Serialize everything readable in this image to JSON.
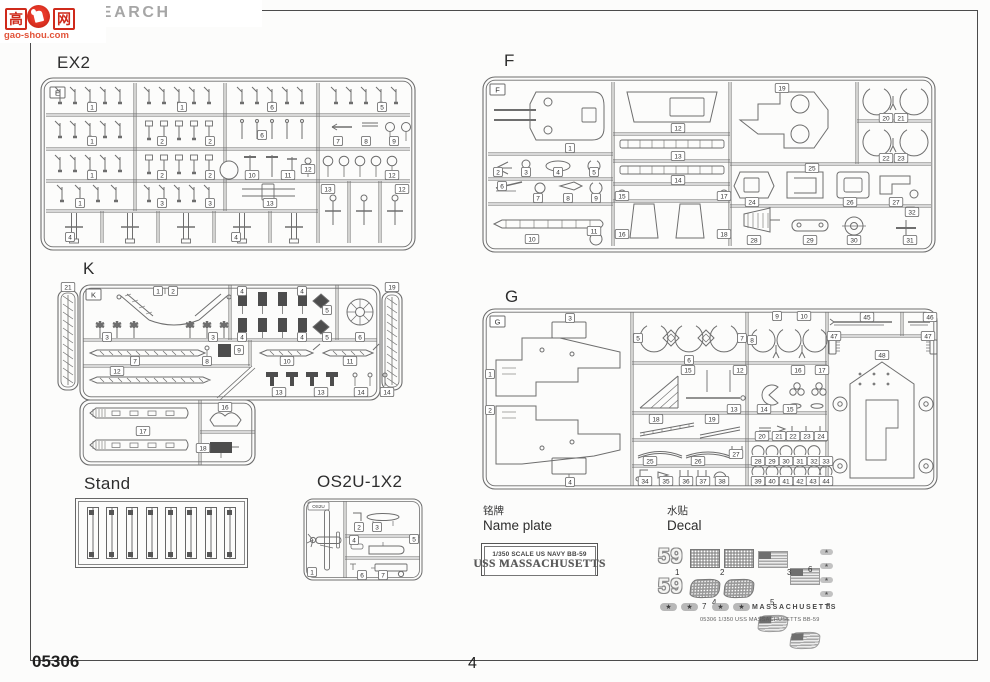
{
  "page": {
    "footer_code": "05306",
    "page_number": "4"
  },
  "watermark": {
    "brand": "HOBBY SEARCH",
    "logo_cn_left": "高",
    "logo_cn_right": "网",
    "logo_site": "gao-shou.com",
    "brand_color": "#a6a6a6",
    "logo_color": "#cf2a1b"
  },
  "sections": {
    "ex2": {
      "title": "EX2",
      "letter": "E"
    },
    "f": {
      "title": "F",
      "letter": "F"
    },
    "k": {
      "title": "K",
      "letter": "K"
    },
    "g": {
      "title": "G",
      "letter": "G"
    },
    "stand": {
      "title": "Stand"
    },
    "os2u": {
      "title": "OS2U-1X2",
      "letter": "OS2U"
    }
  },
  "nameplate": {
    "label_cn": "铭牌",
    "label_en": "Name plate",
    "line1": "1/350  SCALE  US  NAVY  BB-59",
    "line2": "USS MASSACHUSETTS"
  },
  "decal": {
    "label_cn": "水贴",
    "label_en": "Decal",
    "hull_number": "59",
    "ship_name_text": "MASSACHUSETTS",
    "footnote": "05306   1/350 USS MASSACHUSETTS BB-59",
    "item_numbers": [
      "1",
      "2",
      "3",
      "4",
      "5",
      "6",
      "7",
      "8"
    ]
  },
  "part_tags": {
    "e": [
      [
        "1",
        52,
        30
      ],
      [
        "1",
        142,
        30
      ],
      [
        "6",
        232,
        30
      ],
      [
        "5",
        342,
        30
      ],
      [
        "1",
        52,
        64
      ],
      [
        "2",
        122,
        64
      ],
      [
        "2",
        170,
        64
      ],
      [
        "6",
        222,
        58
      ],
      [
        "7",
        298,
        64
      ],
      [
        "8",
        326,
        64
      ],
      [
        "9",
        354,
        64
      ],
      [
        "1",
        52,
        98
      ],
      [
        "2",
        122,
        98
      ],
      [
        "2",
        170,
        98
      ],
      [
        "10",
        212,
        98
      ],
      [
        "11",
        248,
        98
      ],
      [
        "12",
        268,
        92
      ],
      [
        "12",
        352,
        98
      ],
      [
        "1",
        40,
        126
      ],
      [
        "3",
        122,
        126
      ],
      [
        "3",
        170,
        126
      ],
      [
        "13",
        230,
        126
      ],
      [
        "4",
        30,
        160
      ],
      [
        "4",
        196,
        160
      ],
      [
        "13",
        288,
        112
      ],
      [
        "12",
        362,
        112
      ]
    ],
    "f": [
      [
        "1",
        88,
        72
      ],
      [
        "2",
        16,
        96
      ],
      [
        "3",
        44,
        96
      ],
      [
        "4",
        76,
        96
      ],
      [
        "5",
        112,
        96
      ],
      [
        "6",
        20,
        110
      ],
      [
        "7",
        56,
        122
      ],
      [
        "8",
        86,
        122
      ],
      [
        "9",
        114,
        122
      ],
      [
        "10",
        50,
        163
      ],
      [
        "11",
        112,
        155
      ],
      [
        "12",
        196,
        52
      ],
      [
        "13",
        196,
        80
      ],
      [
        "14",
        196,
        104
      ],
      [
        "15",
        140,
        120
      ],
      [
        "17",
        242,
        120
      ],
      [
        "16",
        140,
        158
      ],
      [
        "18",
        242,
        158
      ],
      [
        "19",
        300,
        12
      ],
      [
        "20",
        404,
        42
      ],
      [
        "21",
        419,
        42
      ],
      [
        "22",
        404,
        82
      ],
      [
        "23",
        419,
        82
      ],
      [
        "25",
        330,
        92
      ],
      [
        "24",
        270,
        126
      ],
      [
        "26",
        368,
        126
      ],
      [
        "27",
        414,
        126
      ],
      [
        "28",
        272,
        164
      ],
      [
        "29",
        328,
        164
      ],
      [
        "30",
        372,
        164
      ],
      [
        "32",
        430,
        136
      ],
      [
        "31",
        428,
        164
      ]
    ],
    "k": [
      [
        "21",
        13,
        7
      ],
      [
        "19",
        337,
        7
      ],
      [
        "1",
        103,
        11
      ],
      [
        "2",
        118,
        11
      ],
      [
        "3",
        52,
        57
      ],
      [
        "3",
        158,
        57
      ],
      [
        "4",
        187,
        11
      ],
      [
        "4",
        247,
        11
      ],
      [
        "4",
        187,
        57
      ],
      [
        "4",
        247,
        57
      ],
      [
        "5",
        272,
        30
      ],
      [
        "5",
        272,
        57
      ],
      [
        "6",
        305,
        57
      ],
      [
        "7",
        80,
        81
      ],
      [
        "8",
        152,
        81
      ],
      [
        "9",
        184,
        70
      ],
      [
        "10",
        232,
        81
      ],
      [
        "11",
        295,
        81
      ],
      [
        "12",
        62,
        91
      ],
      [
        "13",
        224,
        112
      ],
      [
        "13",
        266,
        112
      ],
      [
        "14",
        306,
        112
      ],
      [
        "14",
        332,
        112
      ],
      [
        "17",
        88,
        151
      ],
      [
        "16",
        170,
        127
      ],
      [
        "18",
        148,
        168
      ]
    ],
    "g": [
      [
        "3",
        88,
        10
      ],
      [
        "1",
        8,
        66
      ],
      [
        "2",
        8,
        102
      ],
      [
        "4",
        88,
        174
      ],
      [
        "5",
        156,
        30
      ],
      [
        "6",
        207,
        52
      ],
      [
        "7",
        260,
        30
      ],
      [
        "8",
        270,
        32
      ],
      [
        "9",
        295,
        8
      ],
      [
        "10",
        322,
        8
      ],
      [
        "15",
        206,
        62
      ],
      [
        "12",
        258,
        62
      ],
      [
        "13",
        252,
        101
      ],
      [
        "16",
        316,
        62
      ],
      [
        "17",
        340,
        62
      ],
      [
        "14",
        282,
        101
      ],
      [
        "15",
        308,
        101
      ],
      [
        "18",
        174,
        111
      ],
      [
        "19",
        230,
        111
      ],
      [
        "20",
        280,
        128
      ],
      [
        "21",
        297,
        128
      ],
      [
        "22",
        311,
        128
      ],
      [
        "23",
        325,
        128
      ],
      [
        "24",
        339,
        128
      ],
      [
        "25",
        168,
        153
      ],
      [
        "26",
        216,
        153
      ],
      [
        "27",
        254,
        146
      ],
      [
        "28",
        276,
        153
      ],
      [
        "29",
        290,
        153
      ],
      [
        "30",
        304,
        153
      ],
      [
        "31",
        318,
        153
      ],
      [
        "32",
        332,
        153
      ],
      [
        "33",
        344,
        153
      ],
      [
        "34",
        163,
        173
      ],
      [
        "35",
        184,
        173
      ],
      [
        "36",
        204,
        173
      ],
      [
        "37",
        221,
        173
      ],
      [
        "38",
        240,
        173
      ],
      [
        "39",
        276,
        173
      ],
      [
        "40",
        290,
        173
      ],
      [
        "41",
        304,
        173
      ],
      [
        "42",
        318,
        173
      ],
      [
        "43",
        331,
        173
      ],
      [
        "44",
        344,
        173
      ],
      [
        "45",
        385,
        9
      ],
      [
        "46",
        448,
        9
      ],
      [
        "47",
        352,
        28
      ],
      [
        "47",
        446,
        28
      ],
      [
        "48",
        400,
        47
      ]
    ],
    "os2u": [
      [
        "1",
        9,
        74
      ],
      [
        "2",
        56,
        29
      ],
      [
        "3",
        74,
        29
      ],
      [
        "4",
        51,
        42
      ],
      [
        "5",
        111,
        41
      ],
      [
        "6",
        59,
        77
      ],
      [
        "7",
        80,
        77
      ]
    ]
  }
}
